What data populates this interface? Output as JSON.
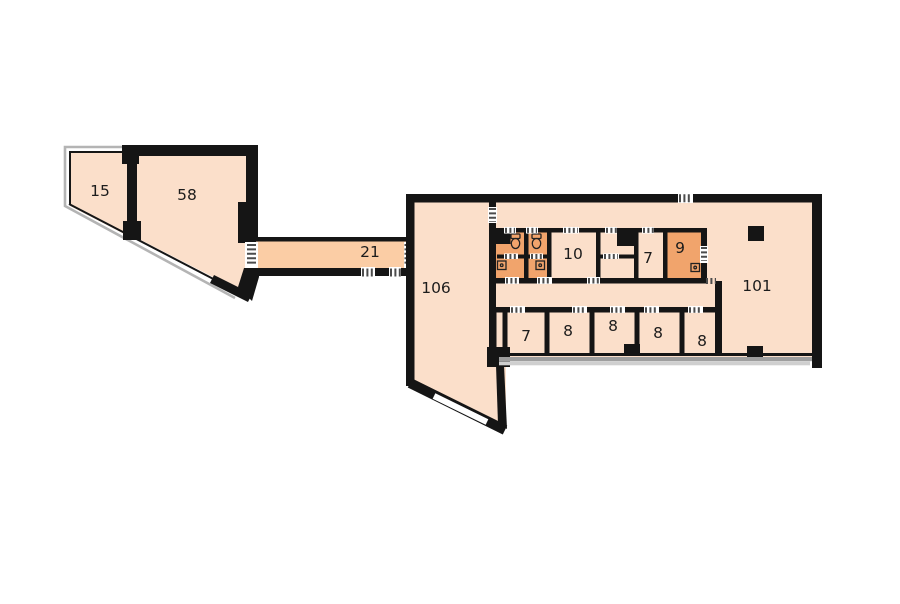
{
  "plan": {
    "title": "Office floor plan",
    "rooms": [
      {
        "id": "room-15",
        "label": "15",
        "type": "room"
      },
      {
        "id": "room-58",
        "label": "58",
        "type": "room"
      },
      {
        "id": "corridor-21",
        "label": "21",
        "type": "corridor"
      },
      {
        "id": "room-106",
        "label": "106",
        "type": "room"
      },
      {
        "id": "room-10",
        "label": "10",
        "type": "room"
      },
      {
        "id": "room-7-upper",
        "label": "7",
        "type": "room"
      },
      {
        "id": "room-9",
        "label": "9",
        "type": "wet-room"
      },
      {
        "id": "room-101",
        "label": "101",
        "type": "room"
      },
      {
        "id": "room-7-lower",
        "label": "7",
        "type": "room"
      },
      {
        "id": "room-8-a",
        "label": "8",
        "type": "room"
      },
      {
        "id": "room-8-b",
        "label": "8",
        "type": "room"
      },
      {
        "id": "room-8-c",
        "label": "8",
        "type": "room"
      },
      {
        "id": "room-8-d",
        "label": "8",
        "type": "room"
      }
    ],
    "fixtures": [
      {
        "name": "toilet-icon",
        "count": 2,
        "location": "wc-cells"
      },
      {
        "name": "sink-icon",
        "count": 3,
        "location": "wc-cells-and-room-9"
      }
    ],
    "colors": {
      "background": "#ffffff",
      "room_fill": "#fbdfca",
      "corridor_fill": "#fbcda5",
      "wet_room_fill": "#f1a46c",
      "wall": "#151515",
      "facade_gray": "#b4b4b4",
      "window_band_dark": "#9e9e9e",
      "window_band_light": "#cfcfcf",
      "door_marker": "#4c4c4c",
      "label_text": "#1c1c1c"
    }
  }
}
